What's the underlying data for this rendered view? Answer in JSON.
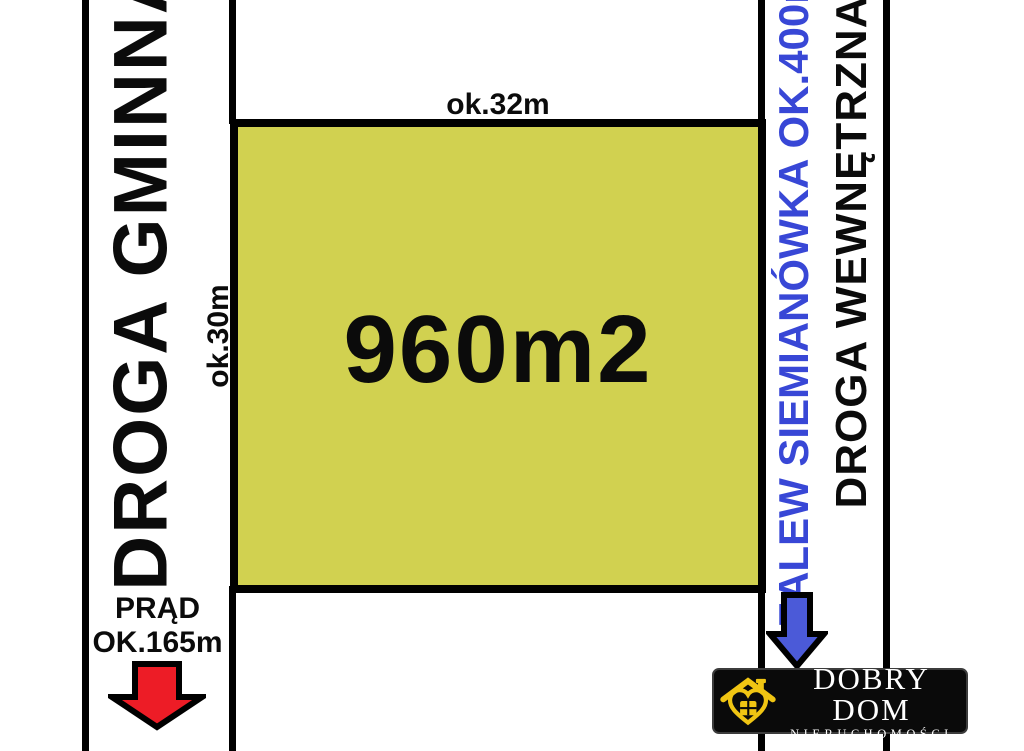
{
  "canvas": {
    "background": "#ffffff",
    "line_color": "#000000"
  },
  "roads": {
    "left_road_label": "DROGA GMINNA",
    "right_road_label": "DROGA WEWNĘTRZNA"
  },
  "plot": {
    "area": "960m2",
    "front_width": "ok.32m",
    "side_depth": "ok.30m",
    "fill_color": "#d1d150"
  },
  "lake_note": {
    "label": "ZALEW SIEMIANÓWKA OK.400m",
    "text_color": "#3847d6",
    "arrow_color": "#4b5ad8",
    "arrow_icon": "blue-down-arrow-icon"
  },
  "power_note": {
    "line1": "PRĄD",
    "line2": "OK.165m",
    "arrow_color": "#ed1c26",
    "arrow_icon": "red-down-arrow-icon"
  },
  "logo": {
    "title": "DOBRY DOM",
    "subtitle": "NIERUCHOMOŚCI",
    "accent_color": "#f0c513",
    "house_icon": "house-heart-icon"
  }
}
